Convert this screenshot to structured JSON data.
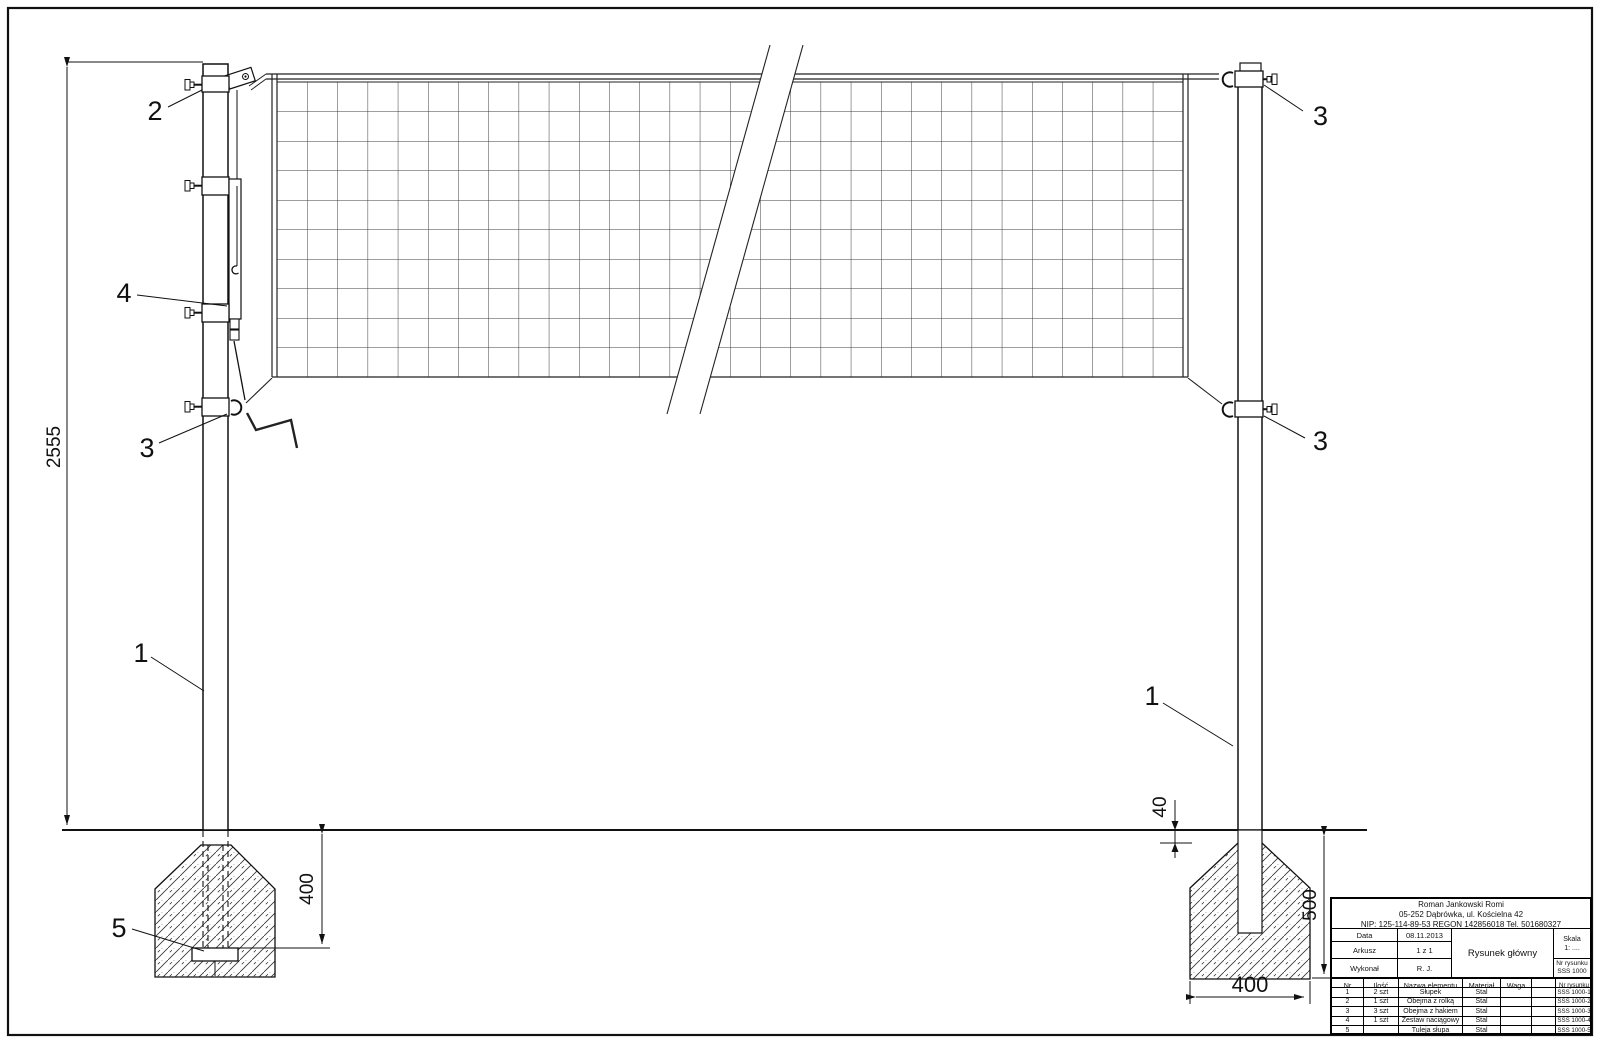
{
  "drawing": {
    "callouts": {
      "post": "1",
      "roller_clamp": "2",
      "hook_clamp": "3",
      "tension_set": "4",
      "post_sleeve": "5"
    },
    "dimensions": {
      "total_height": "2555",
      "embed_left": "400",
      "ground_offset": "40",
      "depth_right": "500",
      "footing_width": "400"
    }
  },
  "title_block": {
    "company": [
      "Roman Jankowski Romi",
      "05-252 Dąbrówka, ul. Kościelna 42",
      "NIP: 125-114-89-53 REGON 142856018 Tel. 501680327"
    ],
    "fields": {
      "data_label": "Data",
      "data_value": "08.11.2013",
      "arkusz_label": "Arkusz",
      "arkusz_value": "1 z 1",
      "wykonal_label": "Wykonał",
      "wykonal_value": "R. J.",
      "title": "Rysunek główny",
      "skala_label": "Skala",
      "skala_value": "1: ....",
      "nr_label": "Nr rysunku",
      "nr_value": "SSS 1000"
    },
    "parts": {
      "headers": [
        "Nr",
        "Ilość",
        "Nazwa elementu",
        "Materiał",
        "Waga",
        "",
        "Nr rysunku"
      ],
      "rows": [
        [
          "1",
          "2 szt",
          "Słupek",
          "Stal",
          "",
          "",
          "SSS 1000-1"
        ],
        [
          "2",
          "1 szt",
          "Obejma z rolką",
          "Stal",
          "",
          "",
          "SSS 1000-2"
        ],
        [
          "3",
          "3 szt",
          "Obejma z hakiem",
          "Stal",
          "",
          "",
          "SSS 1000-3"
        ],
        [
          "4",
          "1 szt",
          "Zestaw naciągowy",
          "Stal",
          "",
          "",
          "SSS 1000-4"
        ],
        [
          "5",
          "",
          "Tuleja słupa",
          "Stal",
          "",
          "",
          "SSS 1000-5"
        ]
      ]
    }
  }
}
